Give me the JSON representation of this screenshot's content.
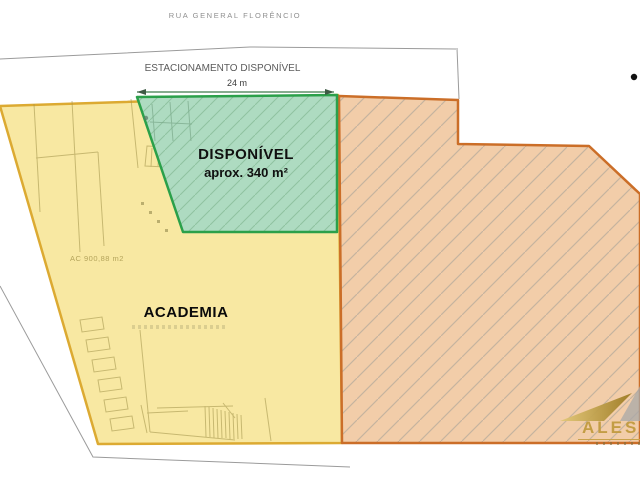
{
  "plan": {
    "street_label": "RUA GENERAL FLORÊNCIO",
    "parking_label": "ESTACIONAMENTO DISPONÍVEL",
    "parking_dimension": "24 m",
    "available": {
      "title": "DISPONÍVEL",
      "area": "aprox. 340 m²",
      "fill": "#aedbc1",
      "border": "#2ba04a"
    },
    "academia": {
      "label": "ACADEMIA",
      "area_note": "AC 900,88 m2",
      "fill": "#f8e8a2",
      "border": "#dcaa32"
    },
    "neighbor": {
      "fill": "#f2cda9",
      "border": "#cb6e28"
    },
    "watermark": {
      "text": "ALESS",
      "color": "#c19b3f"
    }
  }
}
